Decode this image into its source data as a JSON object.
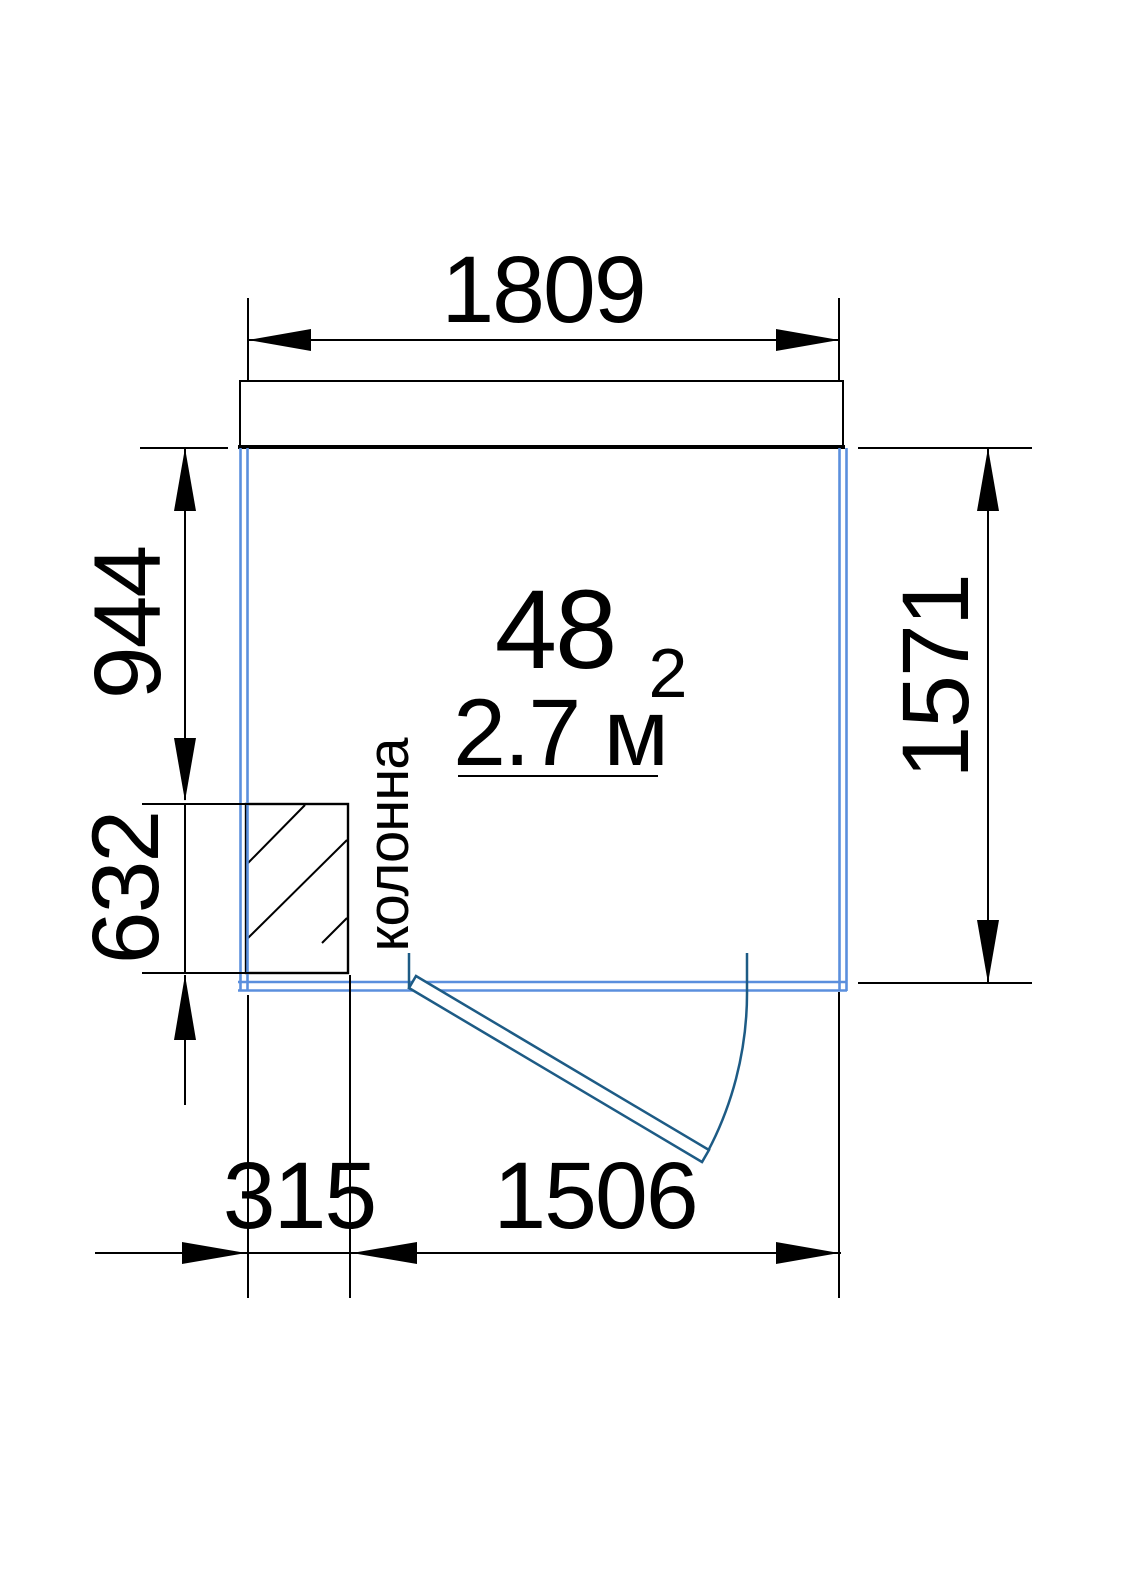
{
  "plan": {
    "room": {
      "number": "48",
      "area": "2.7 м",
      "area_superscript": "2"
    },
    "labels": {
      "column": "колонна"
    },
    "dimensions": {
      "top_width": "1809",
      "right_height": "1571",
      "left_upper": "944",
      "left_lower": "632",
      "bottom_column": "315",
      "bottom_opening": "1506"
    }
  },
  "colors": {
    "bg": "#ffffff",
    "wall": "#5b8fdd",
    "door": "#1d5b85",
    "line": "#000000"
  }
}
